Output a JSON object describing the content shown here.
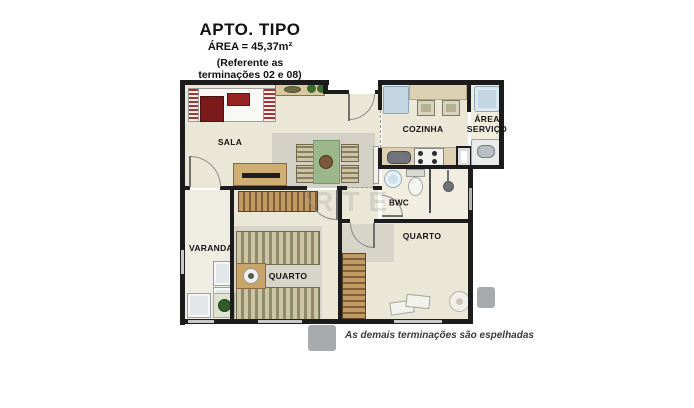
{
  "header": {
    "title": "APTO. TIPO",
    "area": "ÁREA = 45,37m²",
    "note1": "(Referente as",
    "note2": "terminações 02 e 08)"
  },
  "rooms": {
    "sala": "SALA",
    "cozinha": "COZINHA",
    "area_servico": "ÁREA SERVIÇO",
    "bwc": "BWC",
    "varanda": "VARANDA",
    "quarto1": "QUARTO",
    "quarto2": "QUARTO"
  },
  "footnote": "As demais terminações são espelhadas",
  "watermark": "ARTE",
  "colors": {
    "wall": "#1c1c1c",
    "floor": "#ebe7d6",
    "wood": "#c09a62",
    "sofa_red": "#8c2222",
    "table_green": "#9cb78c",
    "water_blue": "#c3d6e2",
    "rug_gray": "#bdbdbd",
    "tab_gray": "#a7abae"
  }
}
